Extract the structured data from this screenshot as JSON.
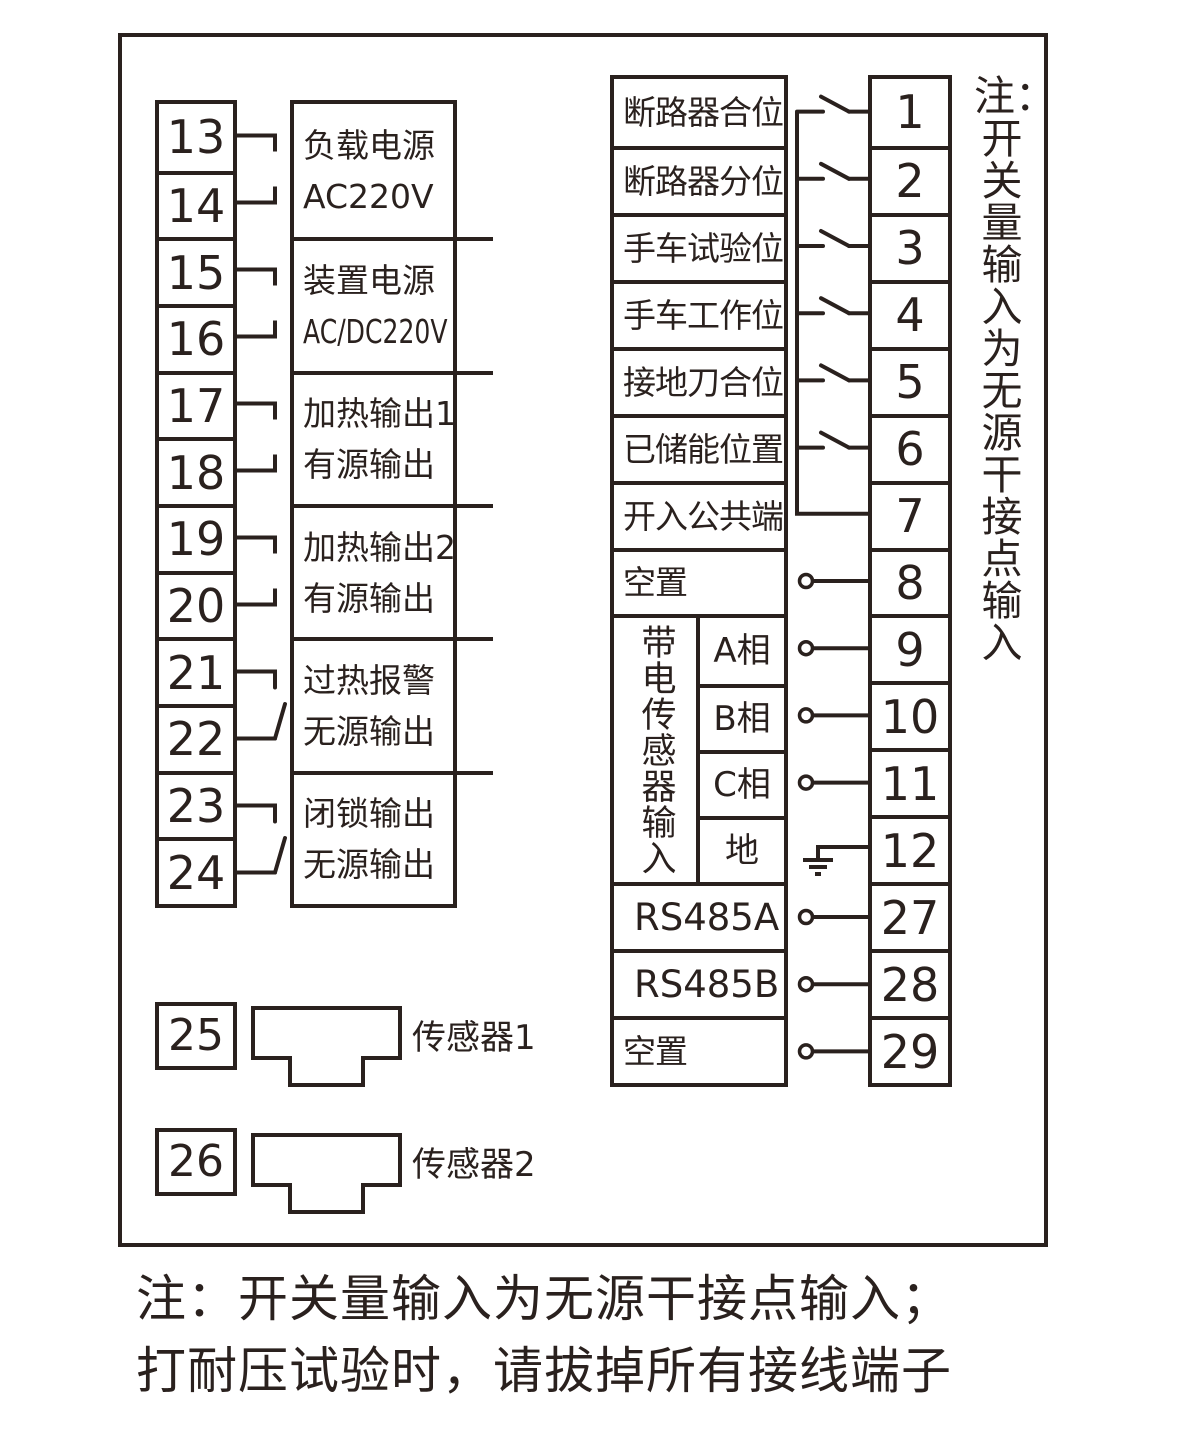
{
  "ink_color": "#2a211e",
  "background_color": "#ffffff",
  "left_panel": {
    "terminal_numbers": [
      "13",
      "14",
      "15",
      "16",
      "17",
      "18",
      "19",
      "20",
      "21",
      "22",
      "23",
      "24"
    ],
    "output_groups": [
      {
        "line1": "负载电源",
        "line2": "AC220V"
      },
      {
        "line1": "装置电源",
        "line2": "AC/DC220V"
      },
      {
        "line1": "加热输出1",
        "line2": "有源输出"
      },
      {
        "line1": "加热输出2",
        "line2": "有源输出"
      },
      {
        "line1": "过热报警",
        "line2": "无源输出"
      },
      {
        "line1": "闭锁输出",
        "line2": "无源输出"
      }
    ],
    "sensors": [
      {
        "terminal": "25",
        "label": "传感器1"
      },
      {
        "terminal": "26",
        "label": "传感器2"
      }
    ]
  },
  "right_panel": {
    "rows": [
      {
        "label": "断路器合位",
        "terminal": "1"
      },
      {
        "label": "断路器分位",
        "terminal": "2"
      },
      {
        "label": "手车试验位",
        "terminal": "3"
      },
      {
        "label": "手车工作位",
        "terminal": "4"
      },
      {
        "label": "接地刀合位",
        "terminal": "5"
      },
      {
        "label": "已储能位置",
        "terminal": "6"
      },
      {
        "label": "开入公共端",
        "terminal": "7"
      },
      {
        "label": "空置",
        "terminal": "8"
      }
    ],
    "sensor_input_group": {
      "vertical_label": "带电传感器输入",
      "channels": [
        {
          "label": "A相",
          "terminal": "9"
        },
        {
          "label": "B相",
          "terminal": "10"
        },
        {
          "label": "C相",
          "terminal": "11"
        },
        {
          "label": "地",
          "terminal": "12"
        }
      ]
    },
    "comm_rows": [
      {
        "label": "RS485A",
        "terminal": "27"
      },
      {
        "label": "RS485B",
        "terminal": "28"
      },
      {
        "label": "空置",
        "terminal": "29"
      }
    ],
    "vertical_note": {
      "prefix": "注：",
      "body": "开关量输入为无源干接点输入"
    }
  },
  "footer_note": {
    "line1": "注：开关量输入为无源干接点输入；",
    "line2": "打耐压试验时，请拔掉所有接线端子"
  }
}
